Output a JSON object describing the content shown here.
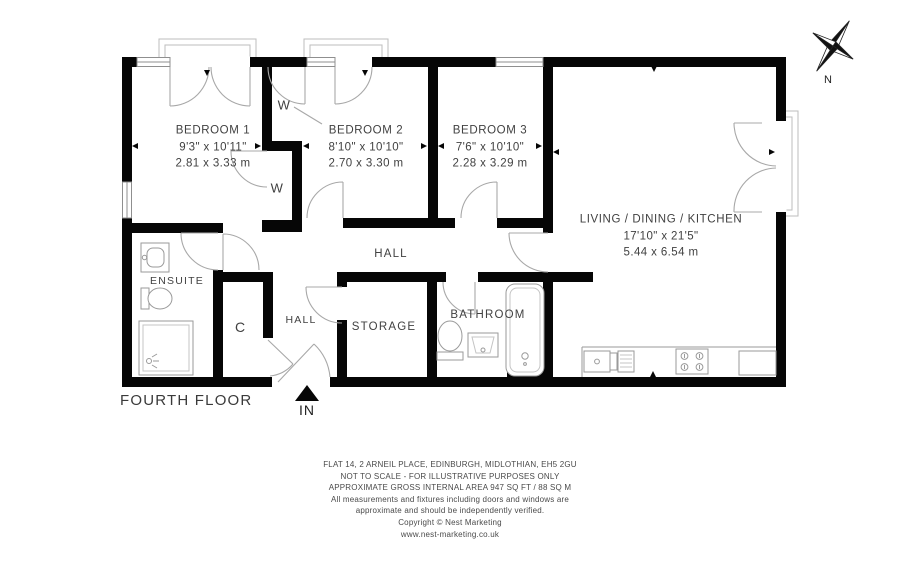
{
  "plan": {
    "floor_label": "FOURTH FLOOR",
    "entrance_label": "IN",
    "compass_label": "N",
    "rooms": {
      "bedroom1": {
        "name": "BEDROOM 1",
        "imperial": "9'3\" x 10'11\"",
        "metric": "2.81 x 3.33 m"
      },
      "bedroom2": {
        "name": "BEDROOM 2",
        "imperial": "8'10\" x 10'10\"",
        "metric": "2.70 x 3.30 m"
      },
      "bedroom3": {
        "name": "BEDROOM 3",
        "imperial": "7'6\" x 10'10\"",
        "metric": "2.28 x 3.29 m"
      },
      "living": {
        "name": "LIVING / DINING / KITCHEN",
        "imperial": "17'10\" x 21'5\"",
        "metric": "5.44 x 6.54 m"
      },
      "ensuite": {
        "name": "ENSUITE"
      },
      "bathroom": {
        "name": "BATHROOM"
      },
      "storage": {
        "name": "STORAGE"
      },
      "hall": {
        "name": "HALL"
      },
      "hall2": {
        "name": "HALL"
      },
      "cupboard": {
        "name": "C"
      },
      "wardrobe1": {
        "name": "W"
      },
      "wardrobe2": {
        "name": "W"
      }
    }
  },
  "footer": {
    "line1": "FLAT 14, 2 ARNEIL PLACE, EDINBURGH, MIDLOTHIAN, EH5 2GU",
    "line2": "NOT TO SCALE - FOR ILLUSTRATIVE PURPOSES ONLY",
    "line3": "APPROXIMATE GROSS INTERNAL AREA 947 SQ FT / 88 SQ M",
    "line4": "All measurements and fixtures including doors and windows are",
    "line5": "approximate and should be independently verified.",
    "line6": "Copyright © Nest Marketing",
    "line7": "www.nest-marketing.co.uk"
  },
  "colors": {
    "wall": "#060606",
    "line": "#a8a8a8",
    "text": "#414141"
  }
}
